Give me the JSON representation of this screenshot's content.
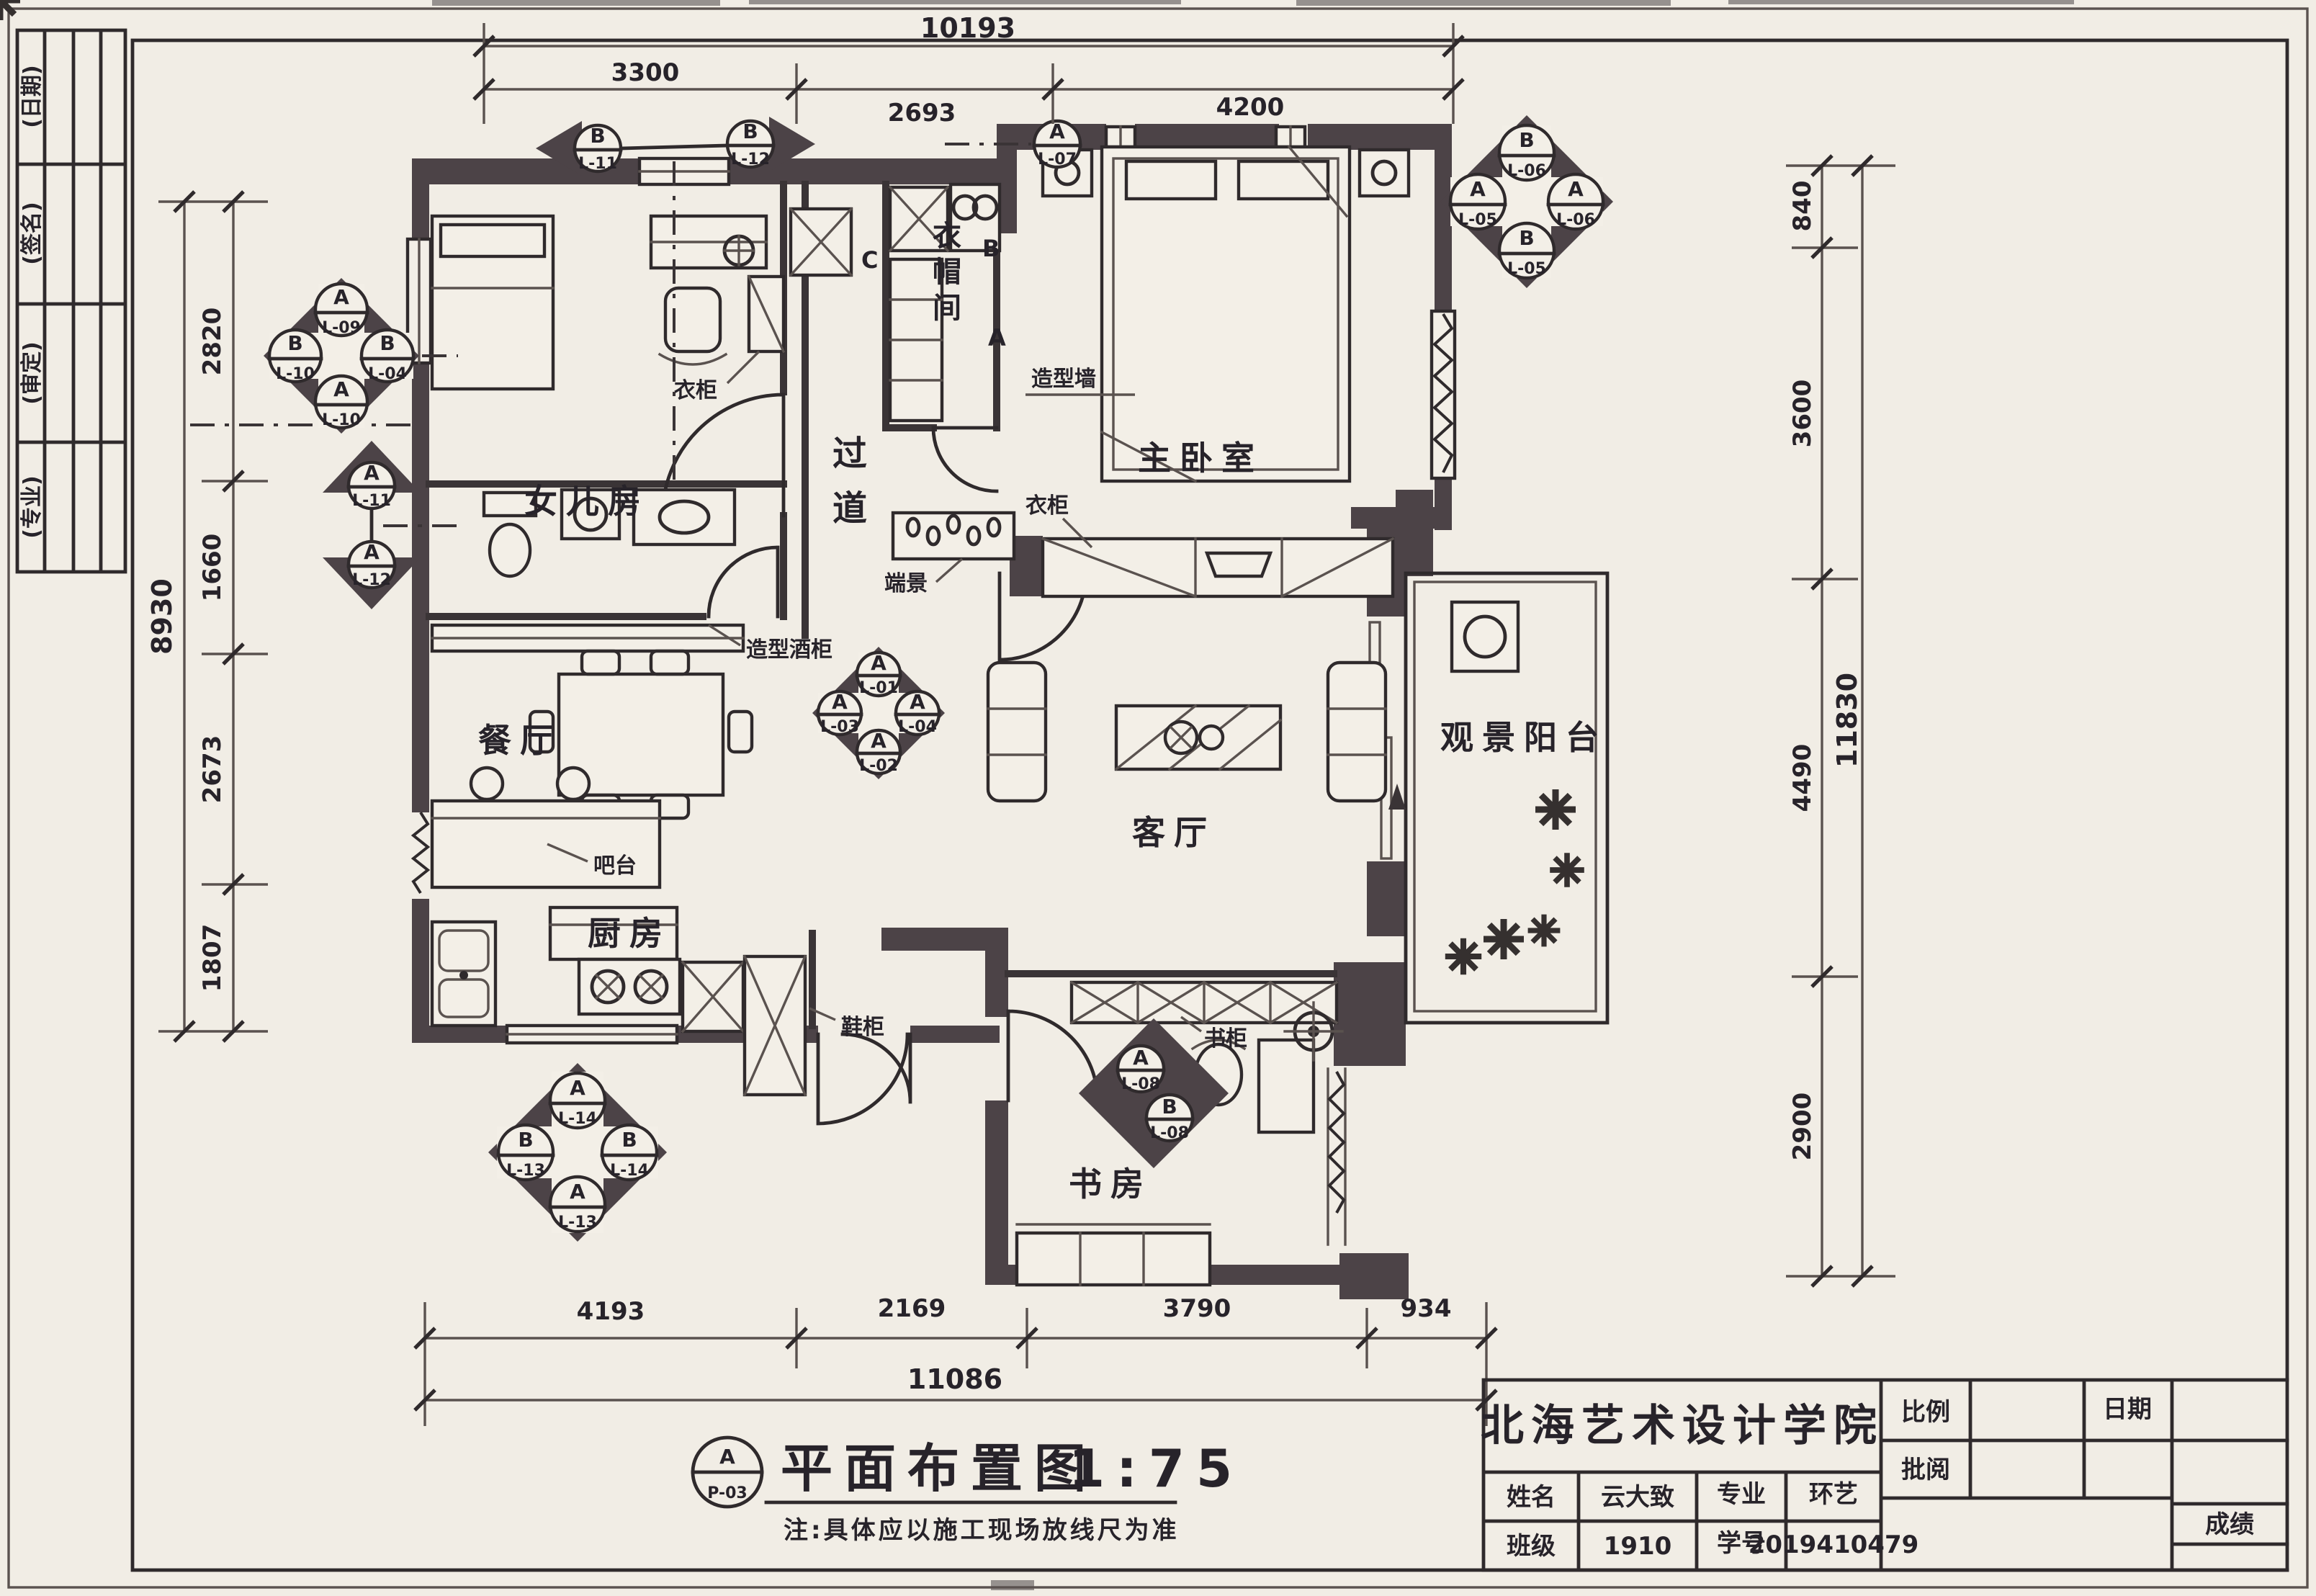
{
  "colors": {
    "paper": "#f1ede5",
    "ink": "#2f2a2c",
    "wall": "#4c4347"
  },
  "side_strip": {
    "rows": [
      "(日期)",
      "(签名)",
      "(审定)",
      "(专业)"
    ]
  },
  "rooms": {
    "daughter": "女儿房",
    "corridor": "过道",
    "cloak": "衣帽间",
    "master": "主卧室",
    "dining": "餐厅",
    "living": "客厅",
    "balcony": "观景阳台",
    "kitchen": "厨房",
    "study": "书房"
  },
  "annotations": {
    "wardrobe_master": "衣柜",
    "wardrobe_daughter": "衣柜",
    "end_view": "端景",
    "feature_wall": "造型墙",
    "wine_cabinet": "造型酒柜",
    "bar": "吧台",
    "shoe_cabinet": "鞋柜",
    "bookcase": "书柜"
  },
  "section_letters": [
    "C",
    "B",
    "A"
  ],
  "markers": {
    "top_pair": {
      "left": {
        "letter": "B",
        "code": "L-11"
      },
      "right": {
        "letter": "B",
        "code": "L-12"
      }
    },
    "top_center": {
      "letter": "A",
      "code": "L-07"
    },
    "tl_cluster": {
      "top": {
        "letter": "A",
        "code": "L-09"
      },
      "left": {
        "letter": "B",
        "code": "L-10"
      },
      "right": {
        "letter": "B",
        "code": "L-04"
      },
      "bottom": {
        "letter": "A",
        "code": "L-10"
      }
    },
    "wall_triangles": {
      "up": {
        "letter": "A",
        "code": "L-11"
      },
      "down": {
        "letter": "A",
        "code": "L-12"
      }
    },
    "tr_cluster": {
      "top": {
        "letter": "B",
        "code": "L-06"
      },
      "left": {
        "letter": "A",
        "code": "L-05"
      },
      "right": {
        "letter": "A",
        "code": "L-06"
      },
      "bottom": {
        "letter": "B",
        "code": "L-05"
      }
    },
    "center_cluster": {
      "top": {
        "letter": "A",
        "code": "L-01"
      },
      "left": {
        "letter": "A",
        "code": "L-03"
      },
      "right": {
        "letter": "A",
        "code": "L-04"
      },
      "bottom": {
        "letter": "A",
        "code": "L-02"
      }
    },
    "study_pair": {
      "top": {
        "letter": "A",
        "code": "L-08"
      },
      "bottom": {
        "letter": "B",
        "code": "L-08"
      }
    },
    "bl_cluster": {
      "top": {
        "letter": "A",
        "code": "L-14"
      },
      "left": {
        "letter": "B",
        "code": "L-13"
      },
      "right": {
        "letter": "B",
        "code": "L-14"
      },
      "bottom": {
        "letter": "A",
        "code": "L-13"
      }
    }
  },
  "dims": {
    "top": {
      "overall": "10193",
      "segments": [
        "3300",
        "2693",
        "4200"
      ]
    },
    "left": {
      "overall": "8930",
      "segments": [
        "2820",
        "1660",
        "2673",
        "1807"
      ]
    },
    "right": {
      "overall": "11830",
      "segments": [
        "840",
        "3600",
        "4490",
        "2900"
      ]
    },
    "bottom": {
      "overall": "11086",
      "segments": [
        "4193",
        "2169",
        "3790",
        "934"
      ]
    }
  },
  "drawing_title": {
    "bubble_top": "A",
    "bubble_bottom": "P-03",
    "title": "平面布置图",
    "scale": "1:75",
    "note": "注:具体应以施工现场放线尺为准"
  },
  "title_block": {
    "school": "北海艺术设计学院",
    "scale_label": "比例",
    "review_label": "批阅",
    "date_label": "日期",
    "grade_label": "成绩",
    "name_label": "姓名",
    "name_value": "云大致",
    "major_label": "专业",
    "major_value": "环艺",
    "class_label": "班级",
    "class_value": "1910",
    "sid_label": "学号",
    "sid_value": "2019410479"
  }
}
